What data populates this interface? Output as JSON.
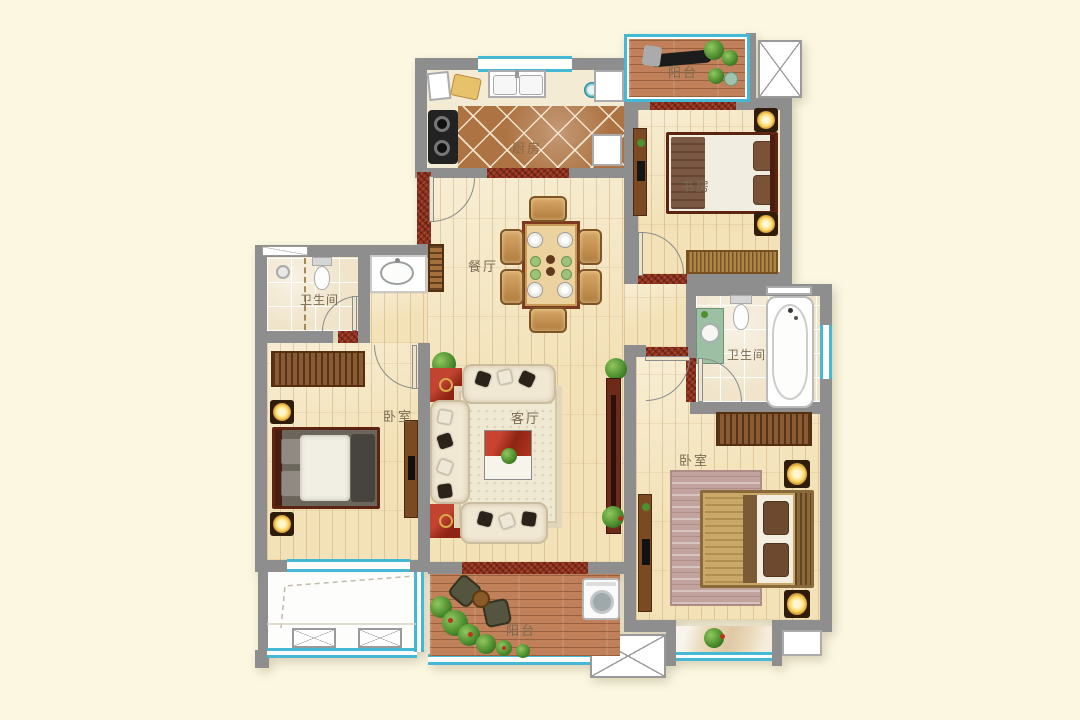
{
  "palette": {
    "background": "#FBF7E1",
    "wall": "#8E8E8E",
    "window_accent": "#45B8D4",
    "wood_floor": "#F3E2B8",
    "kitchen_tile": "#AD7342",
    "bath_tile": "#F0E4CA",
    "deck_wood": "#C08059",
    "brick_red": "#93301C",
    "furniture_red": "#A93122"
  },
  "rooms": {
    "balcony_top": {
      "label": "阳台"
    },
    "study": {
      "label": "书房"
    },
    "kitchen": {
      "label": "厨房"
    },
    "dining": {
      "label": "餐厅"
    },
    "bath_left": {
      "label": "卫生间"
    },
    "bedroom_left": {
      "label": "卧室"
    },
    "living": {
      "label": "客厅"
    },
    "bath_right": {
      "label": "卫生间"
    },
    "bedroom_right": {
      "label": "卧室"
    },
    "balcony_bottom": {
      "label": "阳台"
    }
  }
}
